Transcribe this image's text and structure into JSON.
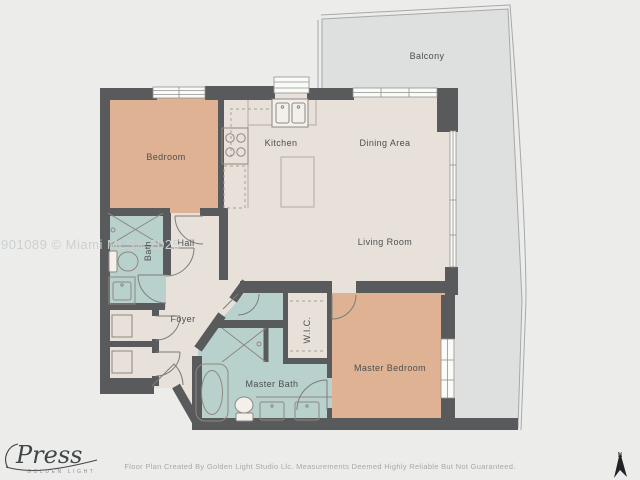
{
  "watermark": "901089 © Miami MLS® 2025",
  "rooms": {
    "balcony": {
      "label": "Balcony"
    },
    "bedroom": {
      "label": "Bedroom"
    },
    "kitchen": {
      "label": "Kitchen"
    },
    "dining": {
      "label": "Dining Area"
    },
    "living": {
      "label": "Living Room"
    },
    "hall": {
      "label": "Hall"
    },
    "bath": {
      "label": "Bath"
    },
    "foyer": {
      "label": "Foyer"
    },
    "wic": {
      "label": "W.I.C."
    },
    "master_bath": {
      "label": "Master Bath"
    },
    "master_bedroom": {
      "label": "Master Bedroom"
    }
  },
  "footer": {
    "disclaimer": "Floor Plan Created By Golden Light Studio Llc. Measurements Deemed Highly Reliable But Not Guaranteed."
  },
  "logo": {
    "script": "Press",
    "subtitle": "GOLDEN LIGHT"
  },
  "compass": {
    "north": "N"
  },
  "colors": {
    "background": "#ecedeb",
    "balcony": "#dee0df",
    "floor": "#e8e1d9",
    "bedroom": "#deb292",
    "bathroom": "#b8d1cc",
    "wall": "#595a5b"
  }
}
